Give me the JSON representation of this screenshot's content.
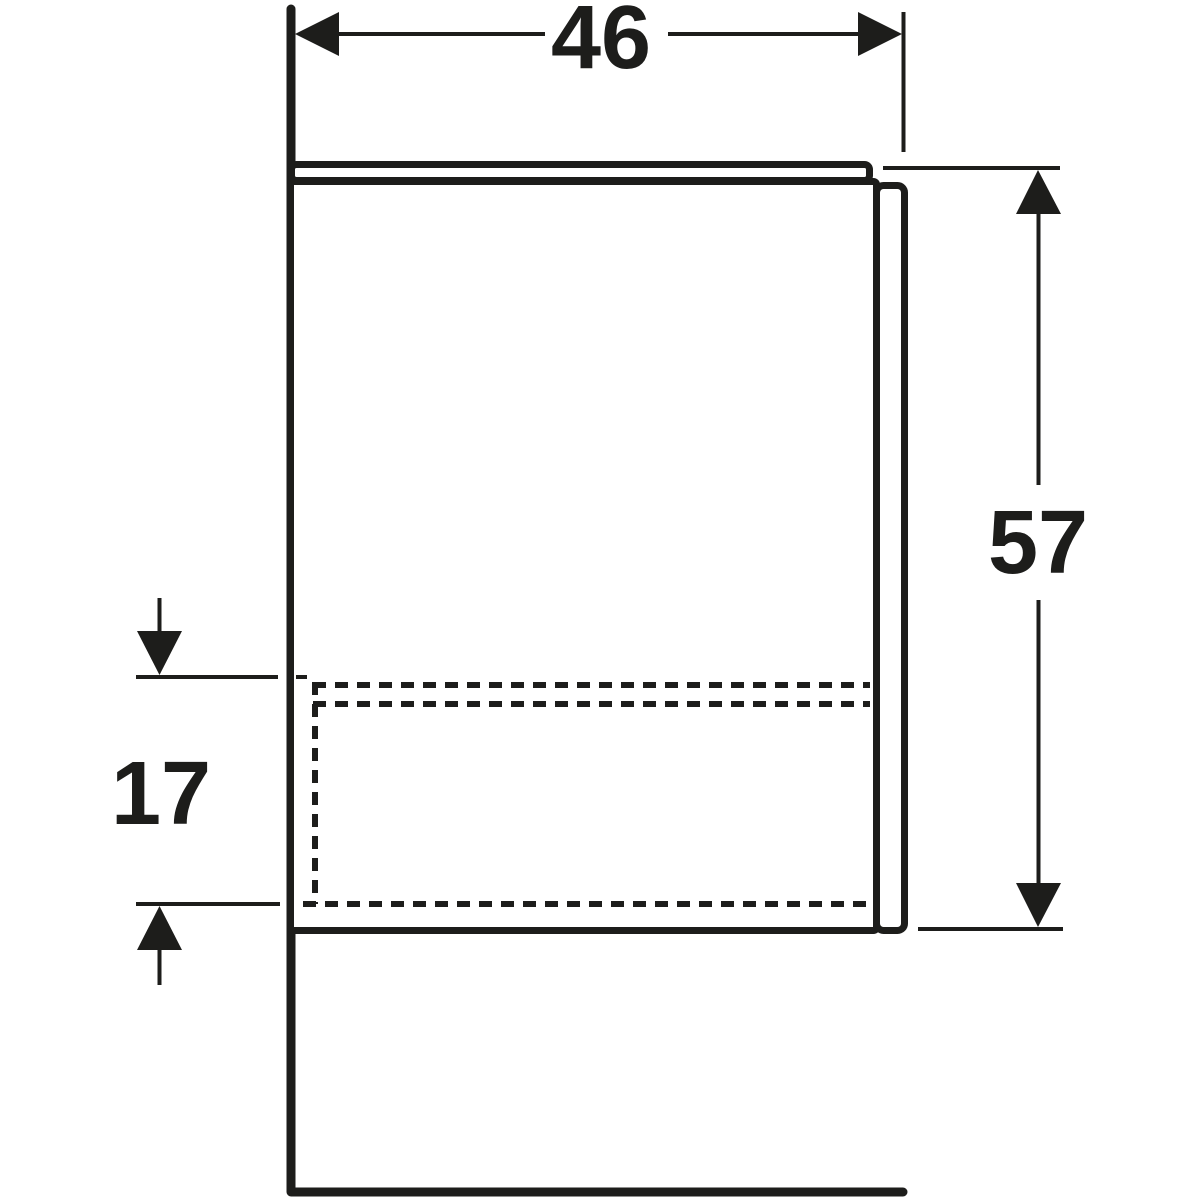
{
  "drawing": {
    "type": "technical-drawing-side-view",
    "subject": "wall-mounted cabinet side profile with drawer shown dashed",
    "dimensions": {
      "width": {
        "label": "46"
      },
      "height": {
        "label": "57"
      },
      "drawer_zone": {
        "label": "17"
      }
    },
    "colors": {
      "line": "#1d1d1b",
      "background": "#ffffff"
    }
  }
}
